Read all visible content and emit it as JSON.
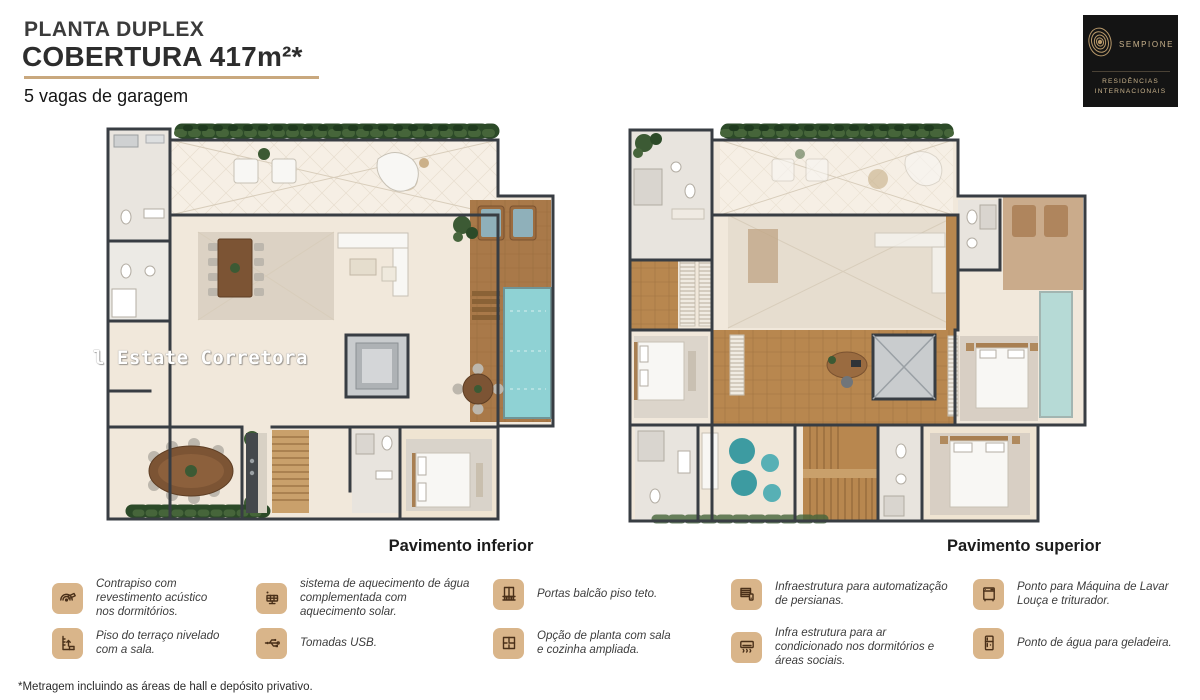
{
  "header": {
    "kicker": "PLANTA DUPLEX",
    "title": "COBERTURA 417m²*",
    "subtitle": "5 vagas de garagem"
  },
  "logo": {
    "brand": "SEMPIONE",
    "tagline_line1": "RESIDÊNCIAS",
    "tagline_line2": "INTERNACIONAIS"
  },
  "plans": {
    "inferior_label": "Pavimento inferior",
    "superior_label": "Pavimento superior"
  },
  "watermark": "l Estate Corretora",
  "features": [
    {
      "icon": "acoustic-floor-icon",
      "text": "Contrapiso com revestimento acústico nos dormitórios."
    },
    {
      "icon": "terrace-level-icon",
      "text": "Piso do terraço nivelado com a sala."
    },
    {
      "icon": "solar-heating-icon",
      "text": "sistema de aquecimento de água complementada com aquecimento solar."
    },
    {
      "icon": "usb-outlet-icon",
      "text": "Tomadas USB."
    },
    {
      "icon": "balcony-doors-icon",
      "text": "Portas balcão piso teto."
    },
    {
      "icon": "floorplan-option-icon",
      "text": "Opção de planta com sala e cozinha ampliada."
    },
    {
      "icon": "blinds-automation-icon",
      "text": "Infraestrutura para automatização de persianas."
    },
    {
      "icon": "air-conditioning-icon",
      "text": "Infra estrutura para ar condicionado nos dormitórios e áreas sociais."
    },
    {
      "icon": "dishwasher-icon",
      "text": "Ponto para Máquina de Lavar Louça e triturador."
    },
    {
      "icon": "fridge-water-icon",
      "text": "Ponto de água para geladeira."
    }
  ],
  "footnote": "*Metragem incluindo as áreas de hall e depósito privativo.",
  "colors": {
    "accent_tan": "#c9a87e",
    "icon_background": "#d9b58a",
    "icon_stroke": "#4a3019",
    "logo_background": "#141414",
    "logo_gold": "#c8b28c",
    "wall": "#383d43",
    "floor_beige": "#f1e8db",
    "wood_floor": "#b8874f",
    "pool_water": "#8fd2d4",
    "hedge_green": "#2c4a28",
    "teal_pouf": "#3d9ba1"
  }
}
